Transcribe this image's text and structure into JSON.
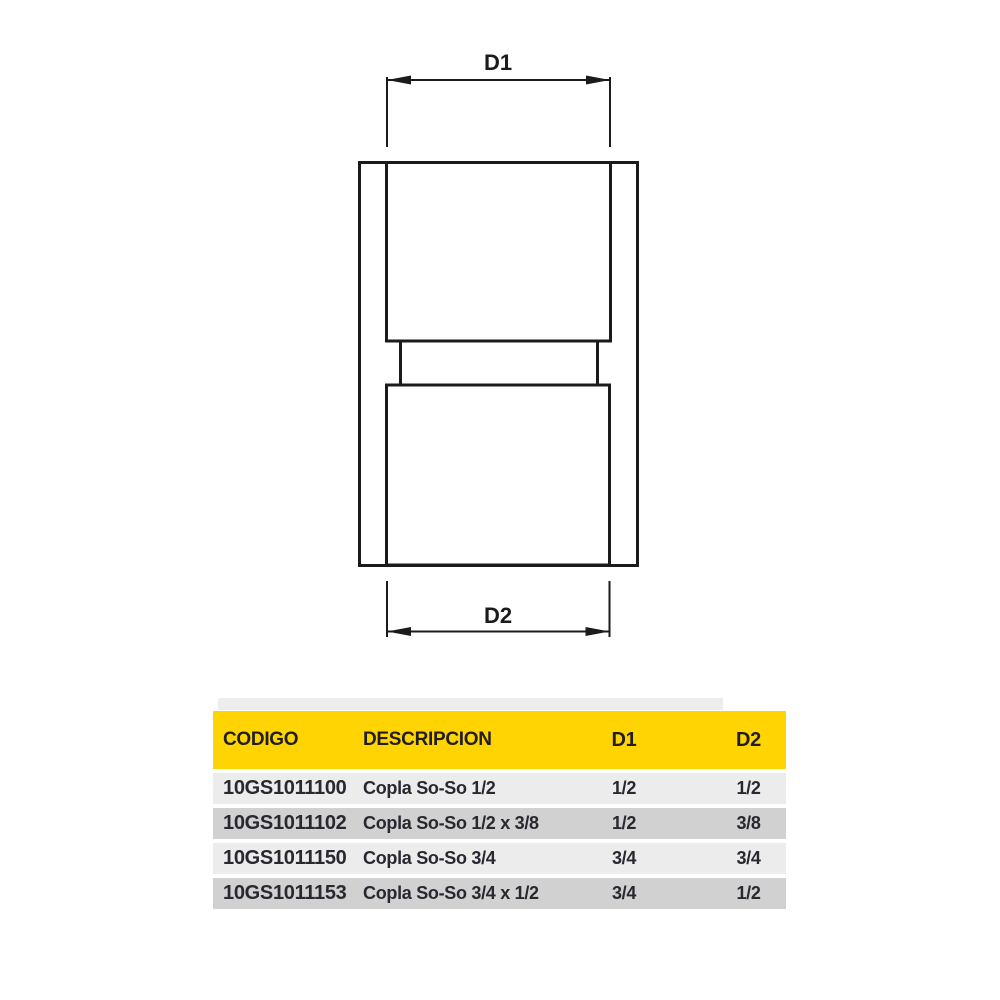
{
  "diagram": {
    "d1_label": "D1",
    "d2_label": "D2",
    "subject": "socket-to-socket pipe coupling, front elevation with top and bottom socket diameters"
  },
  "table": {
    "headers": {
      "codigo": "CODIGO",
      "descripcion": "DESCRIPCION",
      "d1": "D1",
      "d2": "D2"
    },
    "rows": [
      {
        "codigo": "10GS1011100",
        "descripcion": "Copla So-So 1/2",
        "d1": "1/2",
        "d2": "1/2"
      },
      {
        "codigo": "10GS1011102",
        "descripcion": "Copla So-So 1/2 x 3/8",
        "d1": "1/2",
        "d2": "3/8"
      },
      {
        "codigo": "10GS1011150",
        "descripcion": "Copla So-So 3/4",
        "d1": "3/4",
        "d2": "3/4"
      },
      {
        "codigo": "10GS1011153",
        "descripcion": "Copla So-So 3/4 x 1/2",
        "d1": "3/4",
        "d2": "1/2"
      }
    ]
  },
  "colors": {
    "header_bg": "#FFD400",
    "header_text": "#211E22",
    "row_light": "#ECECEC",
    "row_dark": "#D1D1D1",
    "row_text": "#2A2730",
    "strip": "#EDEDED",
    "line": "#1B1B1B",
    "page_bg": "#FFFFFF"
  }
}
